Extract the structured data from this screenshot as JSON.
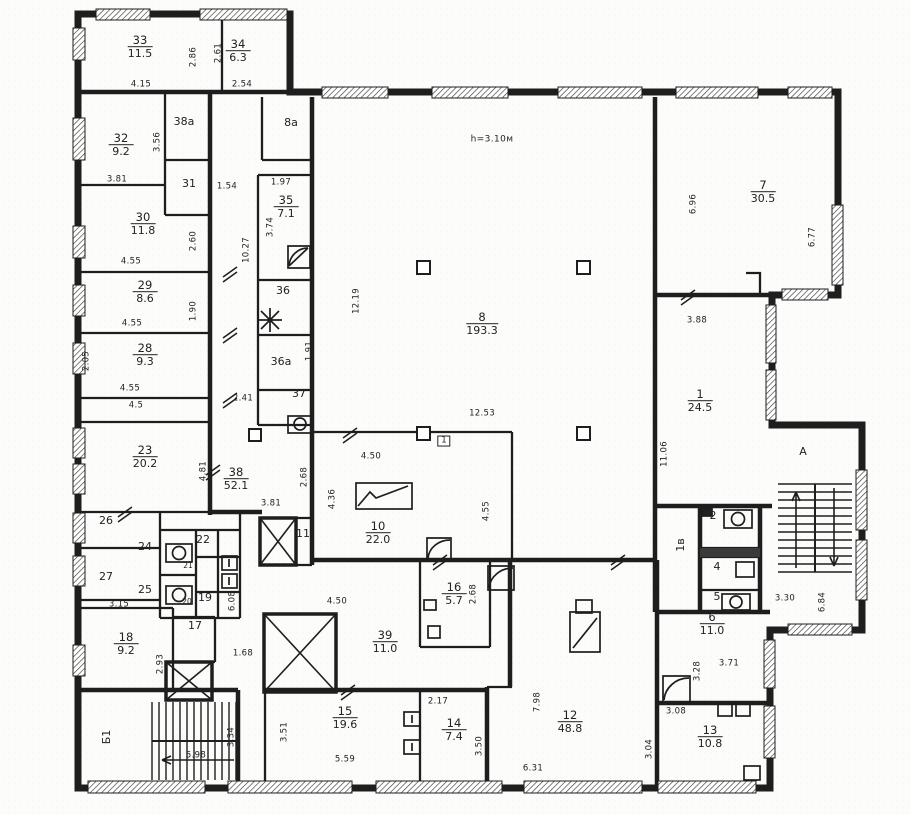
{
  "colors": {
    "ink": "#1e1e1e",
    "paper": "#ffffff"
  },
  "plan": {
    "note": {
      "text": "h=3.10м"
    },
    "rooms": [
      {
        "number": "33",
        "area": "11.5",
        "x": 140,
        "y": 47
      },
      {
        "number": "34",
        "area": "6.3",
        "x": 238,
        "y": 51
      },
      {
        "number": "32",
        "area": "9.2",
        "x": 121,
        "y": 145
      },
      {
        "number": "30",
        "area": "11.8",
        "x": 143,
        "y": 224
      },
      {
        "number": "29",
        "area": "8.6",
        "x": 145,
        "y": 292
      },
      {
        "number": "28",
        "area": "9.3",
        "x": 145,
        "y": 355
      },
      {
        "number": "23",
        "area": "20.2",
        "x": 145,
        "y": 457
      },
      {
        "number": "35",
        "area": "7.1",
        "x": 286,
        "y": 207
      },
      {
        "number": "38",
        "area": "52.1",
        "x": 236,
        "y": 479
      },
      {
        "number": "8",
        "area": "193.3",
        "x": 482,
        "y": 324
      },
      {
        "number": "7",
        "area": "30.5",
        "x": 763,
        "y": 192
      },
      {
        "number": "1",
        "area": "24.5",
        "x": 700,
        "y": 401
      },
      {
        "number": "10",
        "area": "22.0",
        "x": 378,
        "y": 533
      },
      {
        "number": "16",
        "area": "5.7",
        "x": 454,
        "y": 594
      },
      {
        "number": "39",
        "area": "11.0",
        "x": 385,
        "y": 642
      },
      {
        "number": "15",
        "area": "19.6",
        "x": 345,
        "y": 718
      },
      {
        "number": "14",
        "area": "7.4",
        "x": 454,
        "y": 730
      },
      {
        "number": "12",
        "area": "48.8",
        "x": 570,
        "y": 722
      },
      {
        "number": "13",
        "area": "10.8",
        "x": 710,
        "y": 737
      },
      {
        "number": "6",
        "area": "11.0",
        "x": 712,
        "y": 624
      },
      {
        "number": "18",
        "area": "9.2",
        "x": 126,
        "y": 644
      }
    ],
    "cells": [
      {
        "label": "38а",
        "x": 184,
        "y": 122
      },
      {
        "label": "8а",
        "x": 291,
        "y": 123
      },
      {
        "label": "31",
        "x": 189,
        "y": 184
      },
      {
        "label": "36",
        "x": 283,
        "y": 291
      },
      {
        "label": "36а",
        "x": 281,
        "y": 362
      },
      {
        "label": "37",
        "x": 299,
        "y": 394
      },
      {
        "label": "26",
        "x": 106,
        "y": 521
      },
      {
        "label": "24",
        "x": 145,
        "y": 547
      },
      {
        "label": "27",
        "x": 106,
        "y": 577
      },
      {
        "label": "25",
        "x": 145,
        "y": 590
      },
      {
        "label": "22",
        "x": 203,
        "y": 540
      },
      {
        "label": "21",
        "x": 188,
        "y": 566,
        "sm": 1
      },
      {
        "label": "20",
        "x": 187,
        "y": 602,
        "sm": 1
      },
      {
        "label": "19",
        "x": 205,
        "y": 598
      },
      {
        "label": "17",
        "x": 195,
        "y": 626
      },
      {
        "label": "11",
        "x": 303,
        "y": 534
      },
      {
        "label": "2",
        "x": 713,
        "y": 516
      },
      {
        "label": "4",
        "x": 717,
        "y": 567
      },
      {
        "label": "5",
        "x": 717,
        "y": 597
      },
      {
        "label": "1в",
        "x": 681,
        "y": 545,
        "rot": 1
      },
      {
        "label": "Б1",
        "x": 107,
        "y": 737,
        "rot": 1,
        "name": "stair-label"
      },
      {
        "label": "А",
        "x": 803,
        "y": 452,
        "name": "stair-label"
      },
      {
        "label": "1",
        "x": 444,
        "y": 441,
        "boxed": 1,
        "name": "door-number-label"
      },
      {
        "label": "h=3.10м",
        "x": 492,
        "y": 140,
        "md": 1,
        "name": "ceiling-height-note"
      }
    ],
    "dims": [
      {
        "t": "4.15",
        "x": 141,
        "y": 85,
        "rot": 0
      },
      {
        "t": "2.86",
        "x": 194,
        "y": 57,
        "rot": 1
      },
      {
        "t": "2.61",
        "x": 219,
        "y": 53,
        "rot": 1
      },
      {
        "t": "2.54",
        "x": 242,
        "y": 85,
        "rot": 0
      },
      {
        "t": "3.56",
        "x": 158,
        "y": 142,
        "rot": 1
      },
      {
        "t": "3.81",
        "x": 117,
        "y": 180,
        "rot": 0
      },
      {
        "t": "1.54",
        "x": 227,
        "y": 187,
        "rot": 0
      },
      {
        "t": "1.97",
        "x": 281,
        "y": 183,
        "rot": 0
      },
      {
        "t": "3.74",
        "x": 271,
        "y": 227,
        "rot": 1
      },
      {
        "t": "10.27",
        "x": 247,
        "y": 250,
        "rot": 1
      },
      {
        "t": "2.60",
        "x": 194,
        "y": 241,
        "rot": 1
      },
      {
        "t": "4.55",
        "x": 131,
        "y": 262,
        "rot": 0
      },
      {
        "t": "1.90",
        "x": 194,
        "y": 311,
        "rot": 1
      },
      {
        "t": "4.55",
        "x": 132,
        "y": 324,
        "rot": 0
      },
      {
        "t": "2.05",
        "x": 87,
        "y": 361,
        "rot": 1
      },
      {
        "t": "4.55",
        "x": 130,
        "y": 389,
        "rot": 0
      },
      {
        "t": "4.5",
        "x": 136,
        "y": 406,
        "rot": 0
      },
      {
        "t": "4.81",
        "x": 204,
        "y": 471,
        "rot": 1
      },
      {
        "t": "2.41",
        "x": 243,
        "y": 399,
        "rot": 0
      },
      {
        "t": "1.91",
        "x": 310,
        "y": 351,
        "rot": 1
      },
      {
        "t": "12.19",
        "x": 357,
        "y": 301,
        "rot": 1
      },
      {
        "t": "12.53",
        "x": 482,
        "y": 414,
        "rot": 0
      },
      {
        "t": "4.50",
        "x": 371,
        "y": 457,
        "rot": 0
      },
      {
        "t": "4.36",
        "x": 333,
        "y": 499,
        "rot": 1
      },
      {
        "t": "3.81",
        "x": 271,
        "y": 504,
        "rot": 0
      },
      {
        "t": "2.68",
        "x": 305,
        "y": 477,
        "rot": 1
      },
      {
        "t": "4.55",
        "x": 487,
        "y": 511,
        "rot": 1
      },
      {
        "t": "6.96",
        "x": 694,
        "y": 204,
        "rot": 1
      },
      {
        "t": "6.77",
        "x": 813,
        "y": 237,
        "rot": 1
      },
      {
        "t": "3.88",
        "x": 697,
        "y": 321,
        "rot": 0
      },
      {
        "t": "11.06",
        "x": 665,
        "y": 454,
        "rot": 1
      },
      {
        "t": "3.30",
        "x": 785,
        "y": 599,
        "rot": 0
      },
      {
        "t": "6.84",
        "x": 823,
        "y": 602,
        "rot": 1
      },
      {
        "t": "3.15",
        "x": 119,
        "y": 605,
        "rot": 0
      },
      {
        "t": "2.93",
        "x": 161,
        "y": 664,
        "rot": 1
      },
      {
        "t": "6.08",
        "x": 233,
        "y": 601,
        "rot": 1
      },
      {
        "t": "1.68",
        "x": 243,
        "y": 654,
        "rot": 0
      },
      {
        "t": "4.50",
        "x": 337,
        "y": 602,
        "rot": 0
      },
      {
        "t": "2.68",
        "x": 474,
        "y": 594,
        "rot": 1
      },
      {
        "t": "2.17",
        "x": 438,
        "y": 702,
        "rot": 0
      },
      {
        "t": "3.50",
        "x": 480,
        "y": 746,
        "rot": 1
      },
      {
        "t": "3.51",
        "x": 285,
        "y": 732,
        "rot": 1
      },
      {
        "t": "5.59",
        "x": 345,
        "y": 760,
        "rot": 0
      },
      {
        "t": "6.31",
        "x": 533,
        "y": 769,
        "rot": 0
      },
      {
        "t": "7.98",
        "x": 538,
        "y": 702,
        "rot": 1
      },
      {
        "t": "3.34",
        "x": 232,
        "y": 737,
        "rot": 1
      },
      {
        "t": "5.98",
        "x": 196,
        "y": 756,
        "rot": 0
      },
      {
        "t": "3.28",
        "x": 698,
        "y": 671,
        "rot": 1
      },
      {
        "t": "3.71",
        "x": 729,
        "y": 664,
        "rot": 0
      },
      {
        "t": "3.08",
        "x": 676,
        "y": 712,
        "rot": 0
      },
      {
        "t": "3.04",
        "x": 650,
        "y": 749,
        "rot": 1
      }
    ]
  }
}
